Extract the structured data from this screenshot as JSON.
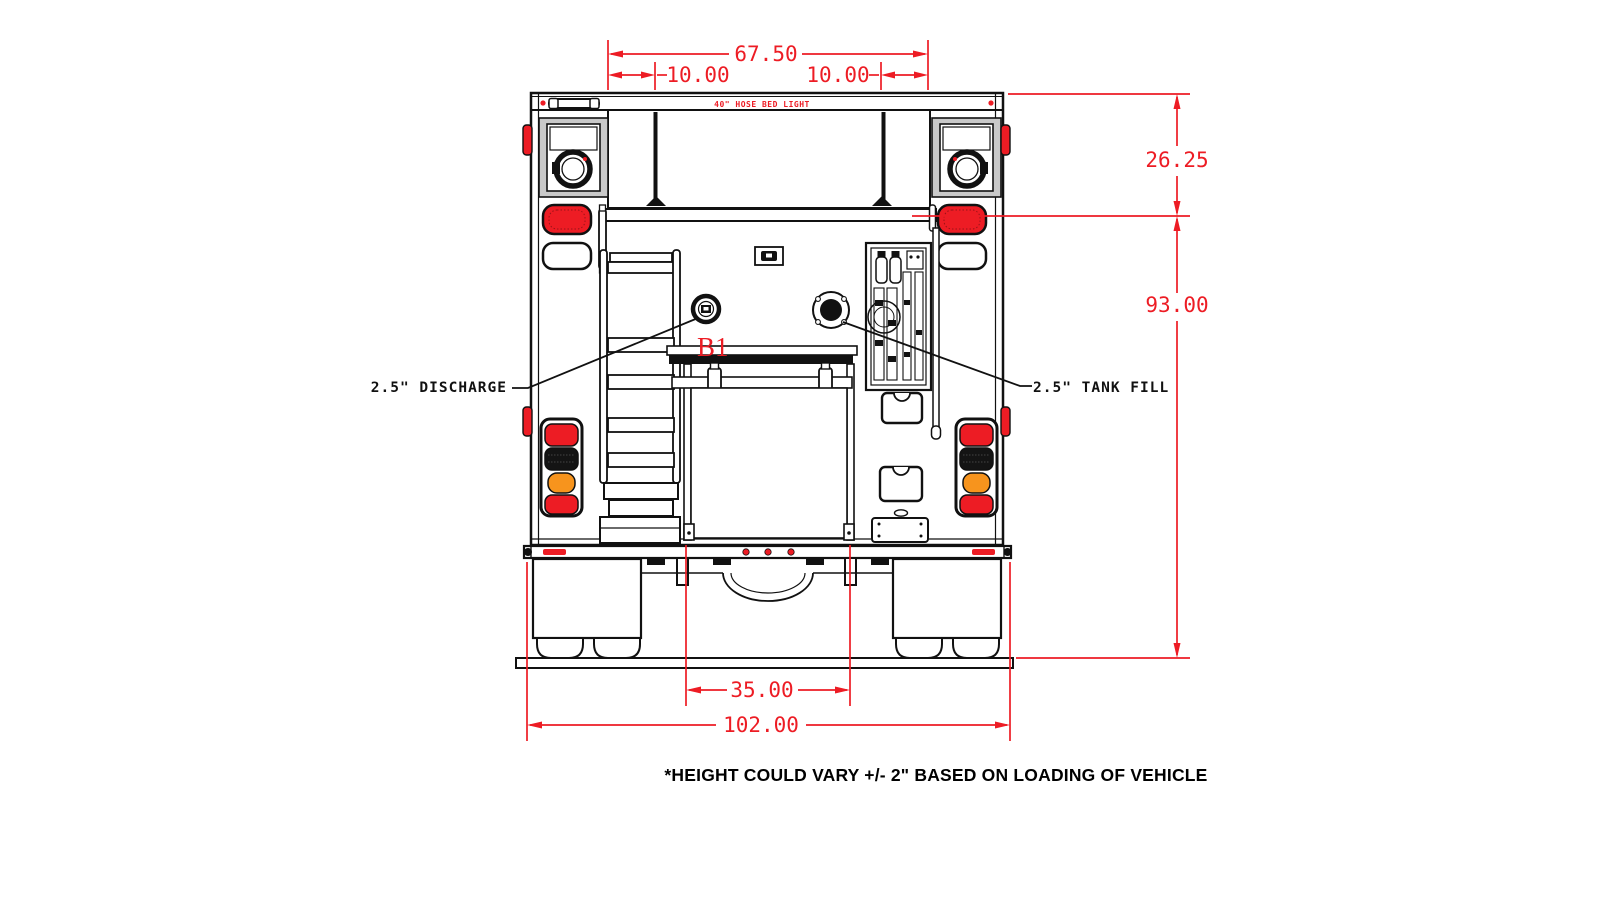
{
  "diagram": {
    "footnote": "*HEIGHT COULD VARY +/- 2\" BASED ON LOADING OF VEHICLE",
    "dimensions": {
      "hose_bed_width": "67.50",
      "hose_bed_left_offset": "10.00",
      "hose_bed_right_offset": "10.00",
      "upper_section_height": "26.25",
      "body_height": "93.00",
      "compartment_width": "35.00",
      "overall_width": "102.00"
    },
    "labels": {
      "discharge": "2.5\" DISCHARGE",
      "tank_fill": "2.5\" TANK FILL",
      "compartment_id": "B1",
      "hose_bed_light": "40\" HOSE BED LIGHT"
    },
    "colors": {
      "dimension_red": "#ed1c24",
      "line_black": "#111111",
      "amber": "#f7941d",
      "panel_gray": "#c9c9c9"
    }
  }
}
